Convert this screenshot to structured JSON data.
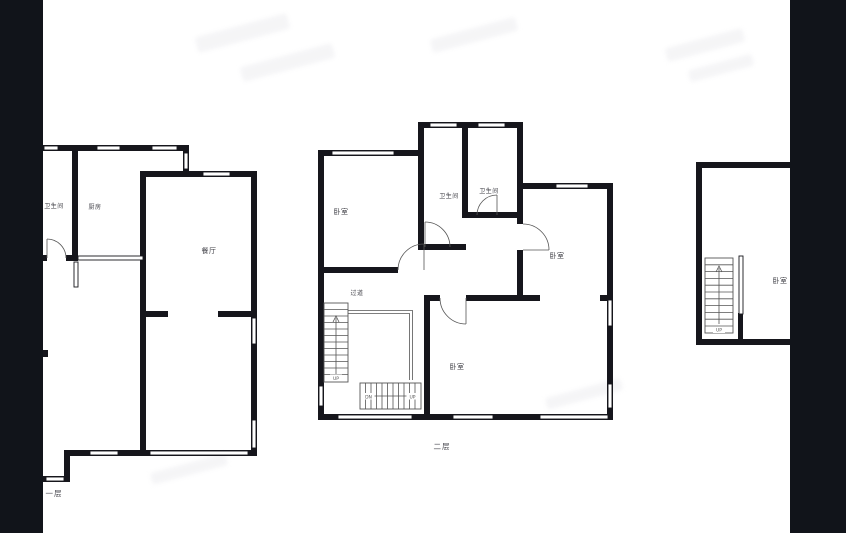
{
  "colors": {
    "wall": "#16161c",
    "sidebar": "#11141a",
    "background": "#ffffff",
    "label_text": "#3f3f46",
    "stair_line": "#555555"
  },
  "plans": {
    "floor1": {
      "floor_label": "一层",
      "rooms": {
        "bathroom": "卫生间",
        "kitchen": "厨房",
        "dining_room": "餐厅"
      }
    },
    "floor2": {
      "floor_label": "二层",
      "rooms": {
        "bedroom_nw": "卧室",
        "bathroom_mid": "卫生间",
        "bathroom_right": "卫生间",
        "bedroom_east": "卧室",
        "hallway": "过道",
        "bedroom_south": "卧室"
      },
      "stair_labels": {
        "left_flight_up": "UP",
        "bottom_flight_dn": "DN",
        "bottom_flight_up": "UP"
      }
    },
    "floor3": {
      "rooms": {
        "bedroom": "卧室"
      },
      "stair_labels": {
        "up": "UP"
      }
    }
  }
}
